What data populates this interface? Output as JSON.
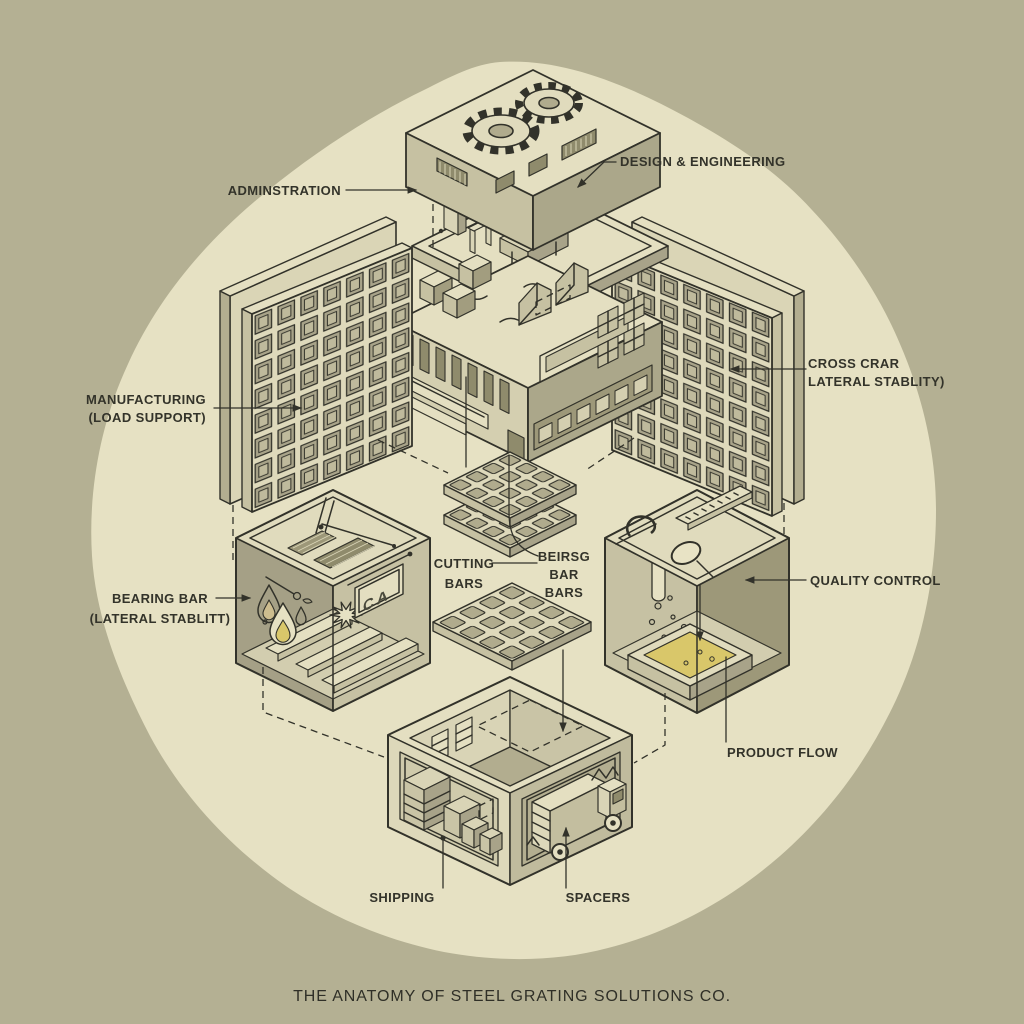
{
  "title": "THE ANATOMY OF STEEL GRATING SOLUTIONS CO.",
  "labels": {
    "administration": "ADMINSTRATION",
    "design_engineering": "DESIGN & ENGINEERING",
    "manufacturing": [
      "MANUFACTURING",
      "(LOAD SUPPORT)"
    ],
    "cross_bar": [
      "CROSS CRAR",
      "LATERAL STABLITY)"
    ],
    "bearing_bar": [
      "BEARING BAR",
      "(LATERAL STABLITT)"
    ],
    "cutting_bars": [
      "CUTTING",
      "BARS"
    ],
    "bearing_bar_bars": [
      "BEIRSG",
      "BAR",
      "BARS"
    ],
    "quality_control": "QUALITY CONTROL",
    "product_flow": "PRODUCT FLOW",
    "shipping": "SHIPPING",
    "spacers": "SPACERS"
  },
  "signs": {
    "ca_board": "CA"
  },
  "colors": {
    "background": "#b4b093",
    "canvas_blob": "#e6e1c3",
    "ink": "#32322a",
    "face_light": "#e4dfc1",
    "face_mid": "#c6c1a2",
    "face_dark": "#a8a389",
    "face_deep": "#8f8b6c",
    "liquid_yellow": "#d9c76a"
  }
}
